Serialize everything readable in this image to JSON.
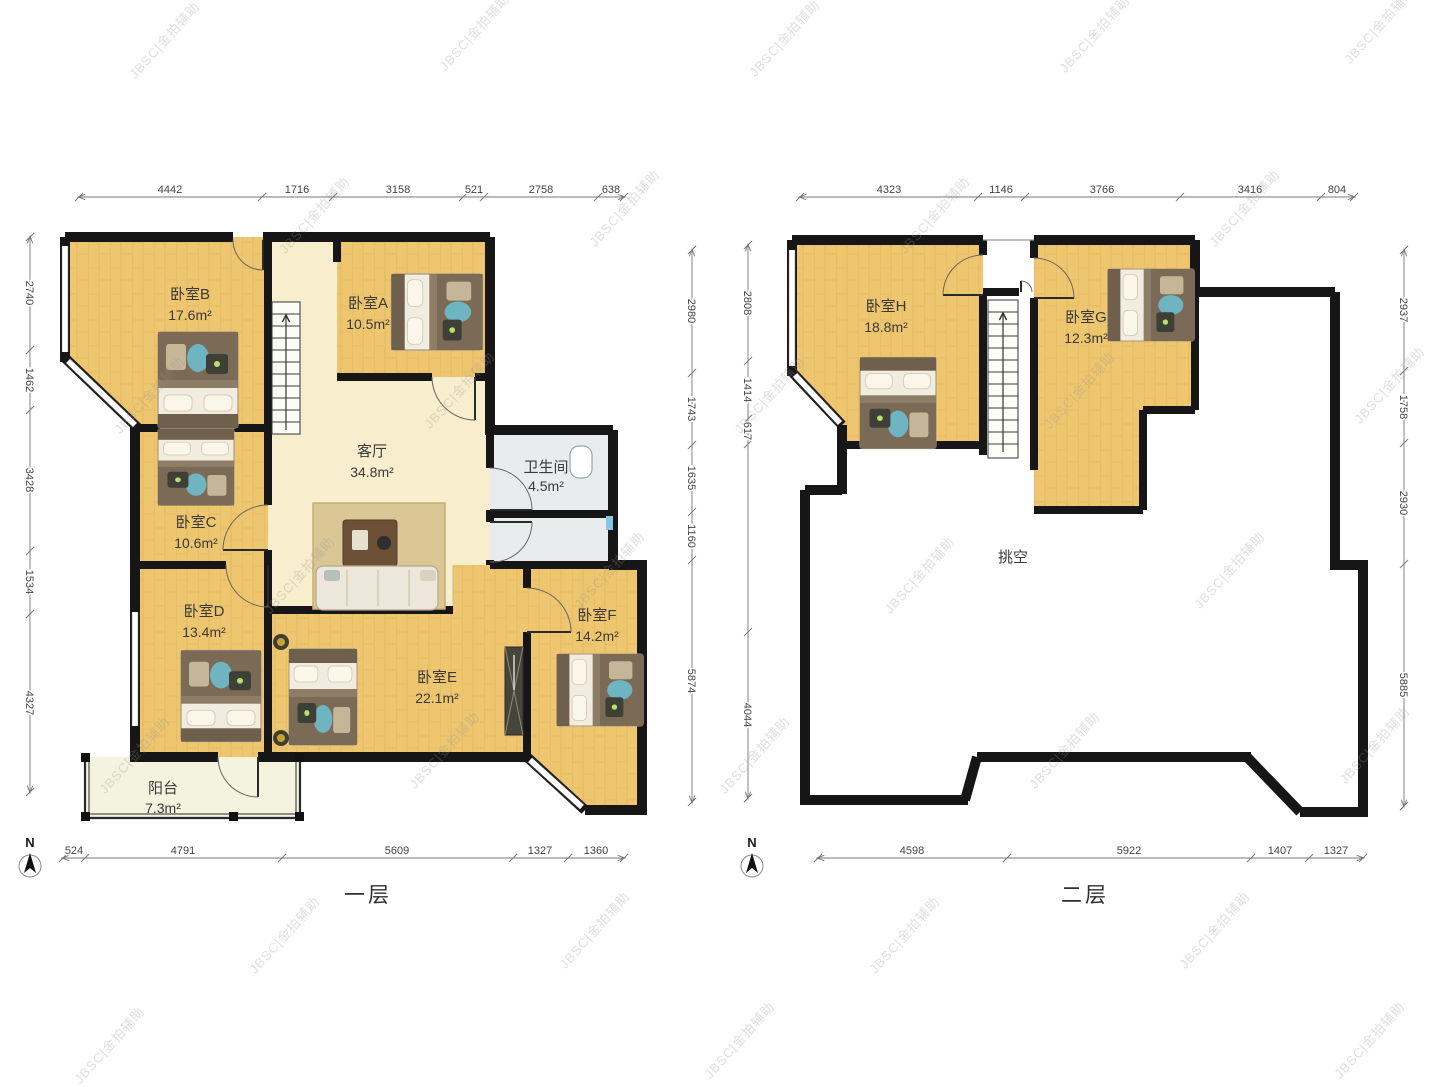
{
  "watermark": "JBSC|金拍辅助",
  "compass_letter": "N",
  "floor1": {
    "label": "一层",
    "dims": {
      "top": [
        "4442",
        "1716",
        "3158",
        "521",
        "2758",
        "638"
      ],
      "left": [
        "2740",
        "1462",
        "3428",
        "1534",
        "4327"
      ],
      "right": [
        "2980",
        "1743",
        "1635",
        "1160",
        "5874"
      ],
      "bottom": [
        "524",
        "4791",
        "5609",
        "1327",
        "1360"
      ]
    },
    "rooms": {
      "b": {
        "name": "卧室B",
        "area": "17.6m²"
      },
      "a": {
        "name": "卧室A",
        "area": "10.5m²"
      },
      "living": {
        "name": "客厅",
        "area": "34.8m²"
      },
      "bath": {
        "name": "卫生间",
        "area": "4.5m²"
      },
      "c": {
        "name": "卧室C",
        "area": "10.6m²"
      },
      "d": {
        "name": "卧室D",
        "area": "13.4m²"
      },
      "e": {
        "name": "卧室E",
        "area": "22.1m²"
      },
      "f": {
        "name": "卧室F",
        "area": "14.2m²"
      },
      "balcony": {
        "name": "阳台",
        "area": "7.3m²"
      }
    }
  },
  "floor2": {
    "label": "二层",
    "dims": {
      "top": [
        "4323",
        "1146",
        "3766",
        "3416",
        "804"
      ],
      "left": [
        "2808",
        "1414",
        "617",
        "4044"
      ],
      "right": [
        "2937",
        "1758",
        "2930",
        "5885"
      ],
      "bottom": [
        "4598",
        "5922",
        "1407",
        "1327"
      ]
    },
    "rooms": {
      "h": {
        "name": "卧室H",
        "area": "18.8m²"
      },
      "g": {
        "name": "卧室G",
        "area": "12.3m²"
      },
      "void": {
        "name": "挑空",
        "area": ""
      }
    }
  }
}
